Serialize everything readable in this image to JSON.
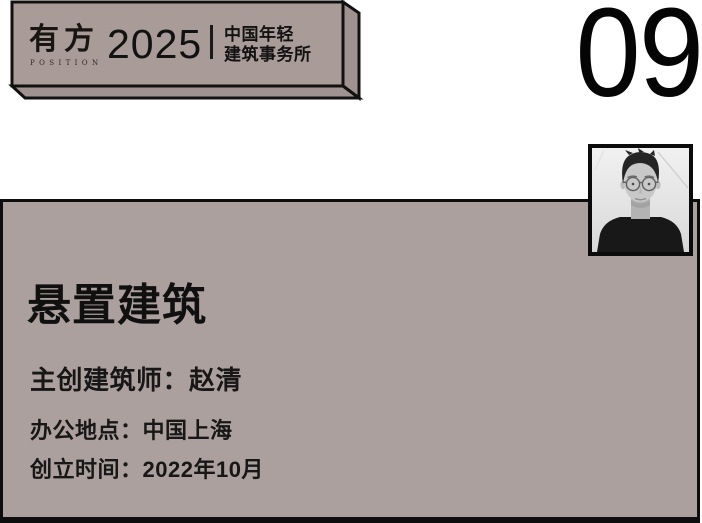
{
  "banner": {
    "logo": {
      "cjk": "有方",
      "latin": "POSITION"
    },
    "year": "2025",
    "tagline": {
      "line1": "中国年轻",
      "line2": "建筑事务所"
    }
  },
  "page_number": "09",
  "card": {
    "title": "悬置建筑",
    "fields": [
      {
        "label": "主创建筑师：",
        "value": "赵清"
      },
      {
        "label": "办公地点：",
        "value": "中国上海"
      },
      {
        "label": "创立时间：",
        "value": "2022年10月"
      }
    ]
  },
  "photo": {
    "alt": "architect-portrait"
  },
  "colors": {
    "mauve_face": "#a89b98",
    "mauve_side": "#a09290",
    "card_fill": "#aba09d",
    "ink": "#0d0d0d",
    "background": "#ffffff"
  }
}
